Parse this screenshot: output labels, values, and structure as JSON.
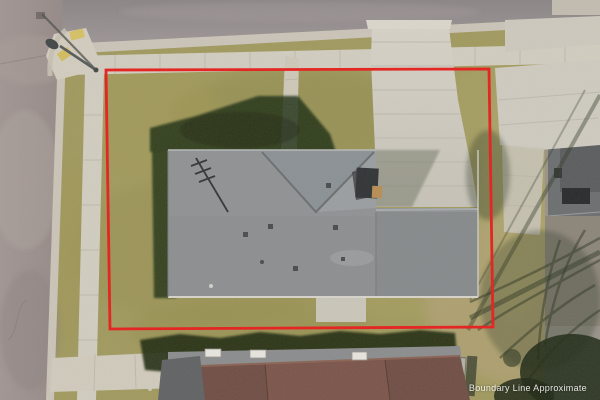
{
  "overlay": {
    "boundary_label": "Boundary Line Approximate",
    "boundary_color": "#e81c1a",
    "label_color": "#ffffff"
  },
  "palette": {
    "lawn": "#a19a5e",
    "concrete": "#d3cec2",
    "road_top": "#918b8d",
    "road_left": "#9d918f",
    "roof_main": "#8f9294",
    "roof_neighbor": "#6f4c44",
    "shadow": "#1c2912"
  }
}
